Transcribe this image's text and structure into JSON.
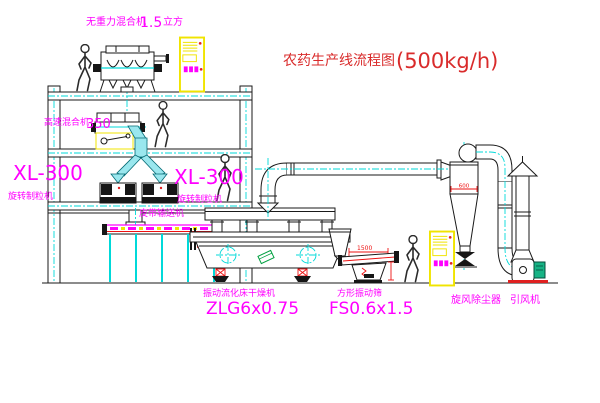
{
  "title": {
    "name": "农药生产线流程图",
    "capacity": "(500kg/h)"
  },
  "equipment": {
    "top_mixer": {
      "name": "无重力混合机",
      "size": "1.5",
      "unit": "立方"
    },
    "mid_mixer": {
      "name": "高速混合机",
      "model": "350"
    },
    "granulator_left": {
      "model": "XL-300",
      "name": "旋转制粒机"
    },
    "granulator_right": {
      "model": "XL-300",
      "name": "旋转制粒机"
    },
    "belt_conveyor": {
      "name": "皮带输送机"
    },
    "dryer": {
      "name": "振动流化床干燥机",
      "model": "ZLG6x0.75"
    },
    "screen": {
      "name": "方形振动筛",
      "model": "FS0.6x1.5"
    },
    "cyclone": {
      "name": "旋风除尘器"
    },
    "fan": {
      "name": "引风机"
    }
  },
  "dimensions": {
    "screen_length": "1500",
    "cyclone_width": "600"
  },
  "colors": {
    "label": "#ff00ff",
    "title": "#d92b2b",
    "dimension": "#ee1111",
    "centerline": "#00d9d9",
    "cabinet": "#f0e400",
    "duct_fill": "#9ae7ee",
    "motor": "#17b385",
    "dryer_accent": "#00a040"
  }
}
